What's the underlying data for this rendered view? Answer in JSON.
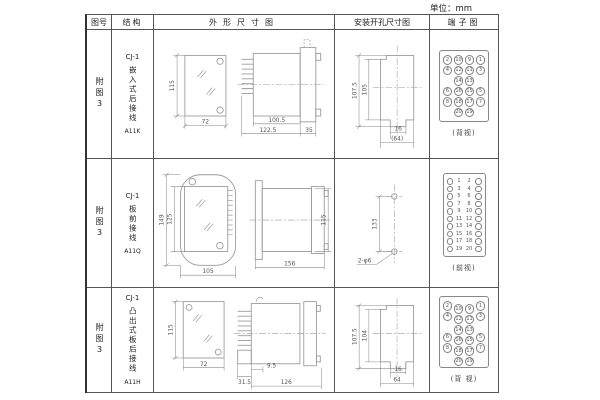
{
  "unit_label": "单位：mm",
  "headers": {
    "fig_no": "图号",
    "structure": "结构",
    "outline": "外形尺寸图",
    "mounting": "安装开孔尺寸图",
    "terminal": "端子图"
  },
  "rows": [
    {
      "fig_label": "附图3",
      "model": "CJ-1",
      "structure_text": "嵌入式后接线",
      "code": "A11K",
      "outline_dims": {
        "height": "115",
        "width": "72",
        "depth_body": "100.5",
        "depth_total": "122.5",
        "flange": "35"
      },
      "mounting_dims": {
        "outer_height": "107.5",
        "inner_height": "105",
        "slot_width": "16",
        "overall_width": "(64)"
      },
      "terminal": {
        "view_label": "(背视)",
        "layout": "grid",
        "grid": [
          [
            "2",
            "10",
            "9",
            "1"
          ],
          [
            "4",
            "12",
            "11",
            "3"
          ],
          [
            "",
            "14",
            "13",
            ""
          ],
          [
            "6",
            "16",
            "15",
            "5"
          ],
          [
            "8",
            "18",
            "17",
            "7"
          ],
          [
            "",
            "20",
            "19",
            ""
          ]
        ]
      }
    },
    {
      "fig_label": "附图3",
      "model": "CJ-1",
      "structure_text": "板前接线",
      "code": "A11Q",
      "outline_dims": {
        "outer_height": "149",
        "inner_height": "125",
        "width": "105",
        "depth": "156",
        "side_height": "115"
      },
      "mounting_dims": {
        "hole_spacing": "133",
        "hole_note": "2-φ6"
      },
      "terminal": {
        "view_label": "(前视)",
        "layout": "pairs",
        "pairs": [
          [
            "1",
            "2"
          ],
          [
            "3",
            "4"
          ],
          [
            "5",
            "6"
          ],
          [
            "7",
            "8"
          ],
          [
            "9",
            "10"
          ],
          [
            "11",
            "12"
          ],
          [
            "13",
            "14"
          ],
          [
            "15",
            "16"
          ],
          [
            "17",
            "18"
          ],
          [
            "19",
            "20"
          ]
        ]
      }
    },
    {
      "fig_label": "附图3",
      "model": "CJ-1",
      "structure_text": "凸出式板后接线",
      "code": "A11H",
      "outline_dims": {
        "height": "115",
        "width": "72",
        "depth_pins": "31.5",
        "depth_step": "9.5",
        "depth_body": "126"
      },
      "mounting_dims": {
        "outer_height": "107.5",
        "inner_height": "104",
        "slot_width": "16",
        "overall_width": "64"
      },
      "terminal": {
        "view_label": "(背 视)",
        "layout": "stagger",
        "grid": [
          [
            "2",
            "10",
            "9",
            "1"
          ],
          [
            "4",
            "12",
            "11",
            "3"
          ],
          [
            "",
            "14",
            "13",
            ""
          ],
          [
            "6",
            "16",
            "15",
            "5"
          ],
          [
            "8",
            "18",
            "17",
            "7"
          ],
          [
            "",
            "20",
            "19",
            ""
          ]
        ]
      }
    }
  ]
}
